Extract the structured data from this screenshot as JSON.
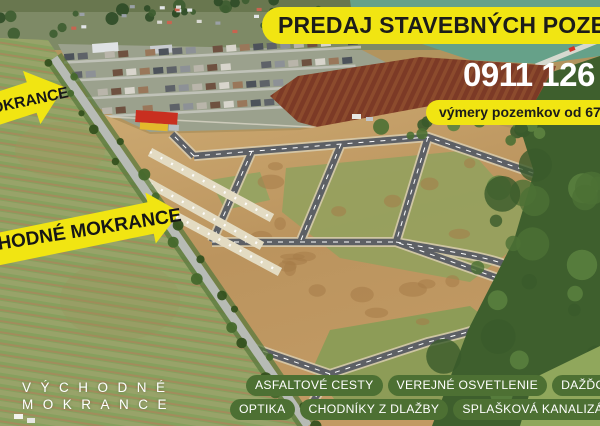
{
  "poster": {
    "banner": "PREDAJ STAVEBNÝCH POZEMKOV",
    "phone": "0911 126",
    "plot_sizes_badge": "výmery pozemkov od 671 m²",
    "location_label": {
      "line1": "VÝCHODNÉ",
      "line2": "MOKRANCE"
    },
    "arrows": {
      "top": "MOKRANCE",
      "main": "VÝCHODNÉ MOKRANCE"
    },
    "features_row1": [
      "ASFALTOVÉ CESTY",
      "VEREJNÉ OSVETLENIE",
      "DAŽĎOVÁ KANALIZÁCIA"
    ],
    "features_row2": [
      "OPTIKA",
      "CHODNÍKY Z DLAŽBY",
      "SPLAŠKOVÁ KANALIZÁCIA"
    ],
    "colors": {
      "accent_yellow": "#f1e512",
      "pill_green": "#4d7033",
      "text_dark": "#1c1c1a",
      "text_white": "#ffffff"
    }
  }
}
